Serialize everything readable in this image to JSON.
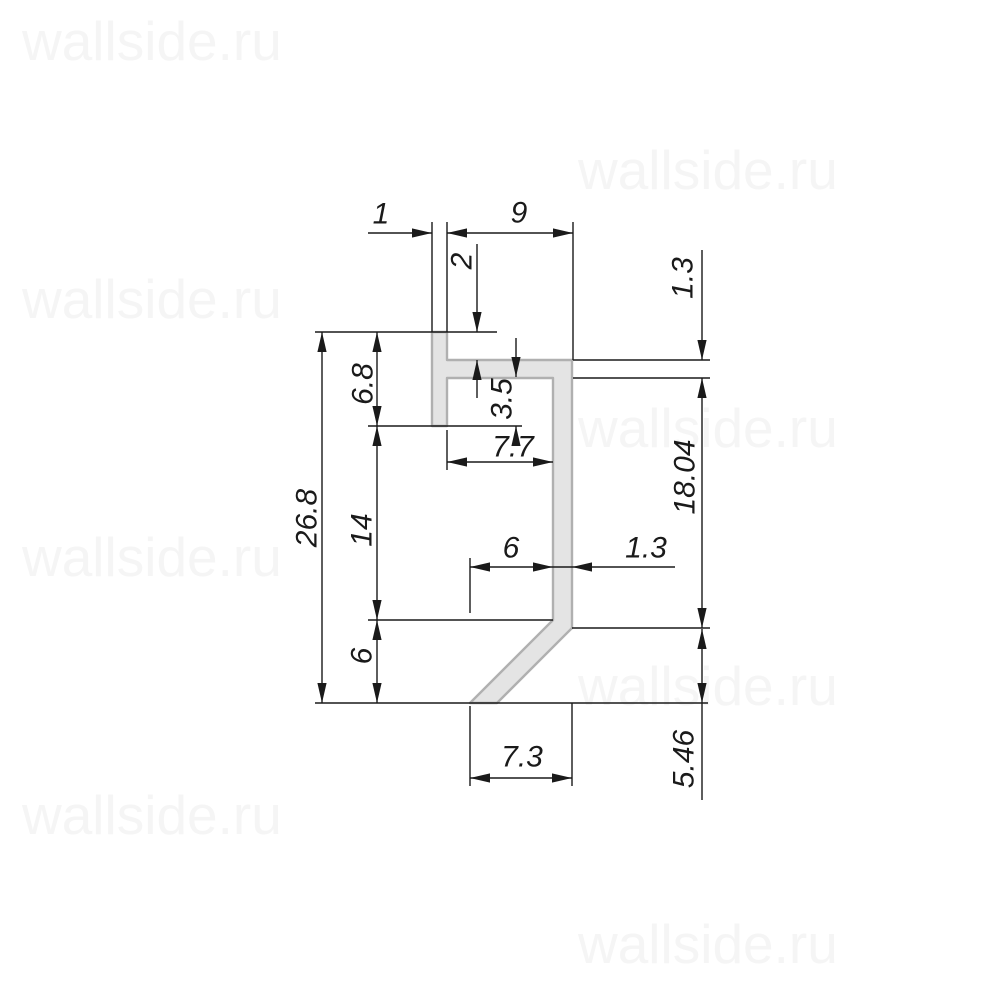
{
  "watermark": {
    "text": "wallside.ru",
    "color": "#f5f5f5",
    "font_size": 55,
    "positions": [
      {
        "x": 22,
        "y": 60
      },
      {
        "x": 578,
        "y": 189
      },
      {
        "x": 22,
        "y": 318
      },
      {
        "x": 578,
        "y": 447
      },
      {
        "x": 22,
        "y": 576
      },
      {
        "x": 578,
        "y": 705
      },
      {
        "x": 22,
        "y": 834
      },
      {
        "x": 578,
        "y": 963
      }
    ]
  },
  "profile": {
    "description": "aluminum profile cross-section",
    "fill": "#e4e4e4",
    "outline": "#b0b0b0",
    "outline_width": 2.4,
    "points": "432,332 447,332 447,360 572,360 572,628 497,703 470,703 553,620 553,378 447,378 447,426 432,426"
  },
  "dimensions": {
    "color": "#1a1a1a",
    "line_width": 1.4,
    "labels": [
      {
        "name": "dim-top-wall-thickness",
        "text": "1",
        "x": 381,
        "y": 214,
        "rot": 0
      },
      {
        "name": "dim-top-width",
        "text": "9",
        "x": 519,
        "y": 213,
        "rot": 0
      },
      {
        "name": "dim-flange-offset",
        "text": "2",
        "x": 462,
        "y": 261,
        "rot": -90
      },
      {
        "name": "dim-lip-depth",
        "text": "3.5",
        "x": 502,
        "y": 399,
        "rot": -90
      },
      {
        "name": "dim-flange-thickness",
        "text": "1.3",
        "x": 683,
        "y": 278,
        "rot": -90
      },
      {
        "name": "dim-wall-height",
        "text": "18.04",
        "x": 685,
        "y": 477,
        "rot": -90
      },
      {
        "name": "dim-foot-height",
        "text": "5.46",
        "x": 684,
        "y": 759,
        "rot": -90
      },
      {
        "name": "dim-total-height",
        "text": "26.8",
        "x": 307,
        "y": 518,
        "rot": -90
      },
      {
        "name": "dim-upper-segment",
        "text": "6.8",
        "x": 363,
        "y": 384,
        "rot": -90
      },
      {
        "name": "dim-middle-segment",
        "text": "14",
        "x": 362,
        "y": 530,
        "rot": -90
      },
      {
        "name": "dim-lower-segment",
        "text": "6",
        "x": 362,
        "y": 656,
        "rot": -90
      },
      {
        "name": "dim-inner-gap",
        "text": "7.7",
        "x": 513,
        "y": 447,
        "rot": 0
      },
      {
        "name": "dim-foot-offset",
        "text": "6",
        "x": 511,
        "y": 548,
        "rot": 0
      },
      {
        "name": "dim-wall-thickness",
        "text": "1.3",
        "x": 646,
        "y": 548,
        "rot": 0
      },
      {
        "name": "dim-bottom-width",
        "text": "7.3",
        "x": 522,
        "y": 757,
        "rot": 0
      }
    ],
    "lines": [
      [
        368,
        233,
        432,
        233
      ],
      [
        447,
        233,
        573,
        233
      ],
      [
        432,
        222,
        432,
        332
      ],
      [
        447,
        222,
        447,
        332
      ],
      [
        573,
        222,
        573,
        360
      ],
      [
        477,
        244,
        477,
        332
      ],
      [
        477,
        360,
        477,
        398
      ],
      [
        516,
        338,
        516,
        377
      ],
      [
        516,
        426,
        516,
        443
      ],
      [
        315,
        332,
        497,
        332
      ],
      [
        368,
        426,
        522,
        426
      ],
      [
        573,
        360,
        710,
        360
      ],
      [
        573,
        378,
        710,
        378
      ],
      [
        702,
        250,
        702,
        360
      ],
      [
        702,
        378,
        702,
        628
      ],
      [
        572,
        628,
        710,
        628
      ],
      [
        702,
        629,
        702,
        800
      ],
      [
        322,
        332,
        322,
        703
      ],
      [
        377,
        332,
        377,
        703
      ],
      [
        368,
        620,
        553,
        620
      ],
      [
        315,
        703,
        708,
        703
      ],
      [
        447,
        430,
        447,
        470
      ],
      [
        447,
        462,
        553,
        462
      ],
      [
        470,
        558,
        470,
        613
      ],
      [
        470,
        567,
        675,
        567
      ],
      [
        470,
        706,
        470,
        786
      ],
      [
        572,
        703,
        572,
        786
      ],
      [
        470,
        778,
        572,
        778
      ]
    ],
    "arrows": [
      {
        "x": 432,
        "y": 233,
        "dir": "right"
      },
      {
        "x": 447,
        "y": 233,
        "dir": "left"
      },
      {
        "x": 573,
        "y": 233,
        "dir": "right"
      },
      {
        "x": 477,
        "y": 332,
        "dir": "down"
      },
      {
        "x": 477,
        "y": 360,
        "dir": "up"
      },
      {
        "x": 516,
        "y": 377,
        "dir": "down"
      },
      {
        "x": 516,
        "y": 426,
        "dir": "up"
      },
      {
        "x": 702,
        "y": 360,
        "dir": "down"
      },
      {
        "x": 702,
        "y": 378,
        "dir": "up"
      },
      {
        "x": 702,
        "y": 628,
        "dir": "down"
      },
      {
        "x": 702,
        "y": 629,
        "dir": "up"
      },
      {
        "x": 702,
        "y": 703,
        "dir": "down"
      },
      {
        "x": 322,
        "y": 332,
        "dir": "up"
      },
      {
        "x": 322,
        "y": 703,
        "dir": "down"
      },
      {
        "x": 377,
        "y": 332,
        "dir": "up"
      },
      {
        "x": 377,
        "y": 426,
        "dir": "down"
      },
      {
        "x": 377,
        "y": 426,
        "dir": "up"
      },
      {
        "x": 377,
        "y": 620,
        "dir": "down"
      },
      {
        "x": 377,
        "y": 620,
        "dir": "up"
      },
      {
        "x": 377,
        "y": 703,
        "dir": "down"
      },
      {
        "x": 447,
        "y": 462,
        "dir": "left"
      },
      {
        "x": 553,
        "y": 462,
        "dir": "right"
      },
      {
        "x": 470,
        "y": 567,
        "dir": "left"
      },
      {
        "x": 553,
        "y": 567,
        "dir": "right"
      },
      {
        "x": 572,
        "y": 567,
        "dir": "left"
      },
      {
        "x": 470,
        "y": 778,
        "dir": "left"
      },
      {
        "x": 572,
        "y": 778,
        "dir": "right"
      }
    ]
  }
}
